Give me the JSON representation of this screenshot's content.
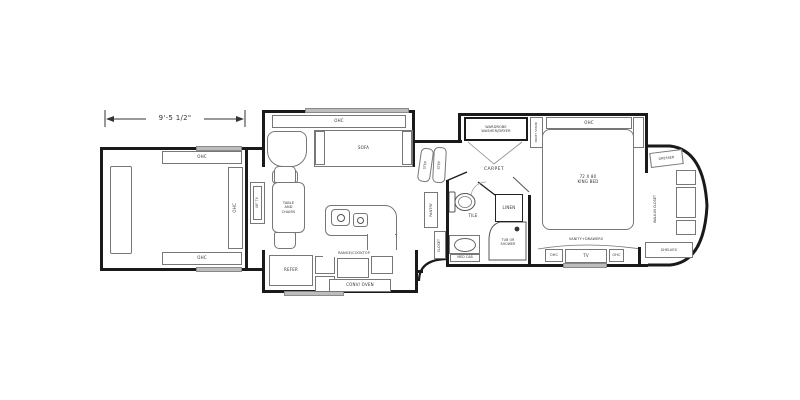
{
  "dimension": {
    "front_width": "9'-5 1/2\""
  },
  "front_room": {
    "ohc_top": "OHC",
    "ohc_bottom": "OHC",
    "ohc_side": "OHC"
  },
  "living": {
    "ohc": "OHC",
    "sofa": "SOFA",
    "tv": "48\" TV",
    "table_chairs": "TABLE AND CHAIRS"
  },
  "kitchen": {
    "refer": "REFER",
    "range": "RANGE/COOKTOP",
    "conv_oven": "CONV/ OVEN",
    "pantry": "PANTRY",
    "closet": "CLOSET",
    "step_upper": "STEP",
    "step_lower": "STEP"
  },
  "bath": {
    "tile": "TILE",
    "linen": "LINEN",
    "tub_shower": "TUB OR SHOWER",
    "med_cab": "MED CAB"
  },
  "bedroom": {
    "carpet": "CARPET",
    "wardrobe_line1": "WARDROBE",
    "wardrobe_line2": "WASHER/DRYER",
    "night_stand": "NIGHT STAND",
    "ohc": "OHC",
    "bed_size": "72 X 80",
    "bed_type": "KING BED",
    "dresser": "DRESSER",
    "walk_in_closet": "WALK-IN CLOSET",
    "shelves": "SHELVES",
    "vanity": "VANITY+DRAWERS",
    "tv": "TV",
    "ohc_left": "OHC",
    "ohc_right": "OHC"
  },
  "colors": {
    "wall": "#1a1a1a",
    "line": "#777777",
    "window_glass": "#bdbdbd",
    "background": "#ffffff"
  }
}
